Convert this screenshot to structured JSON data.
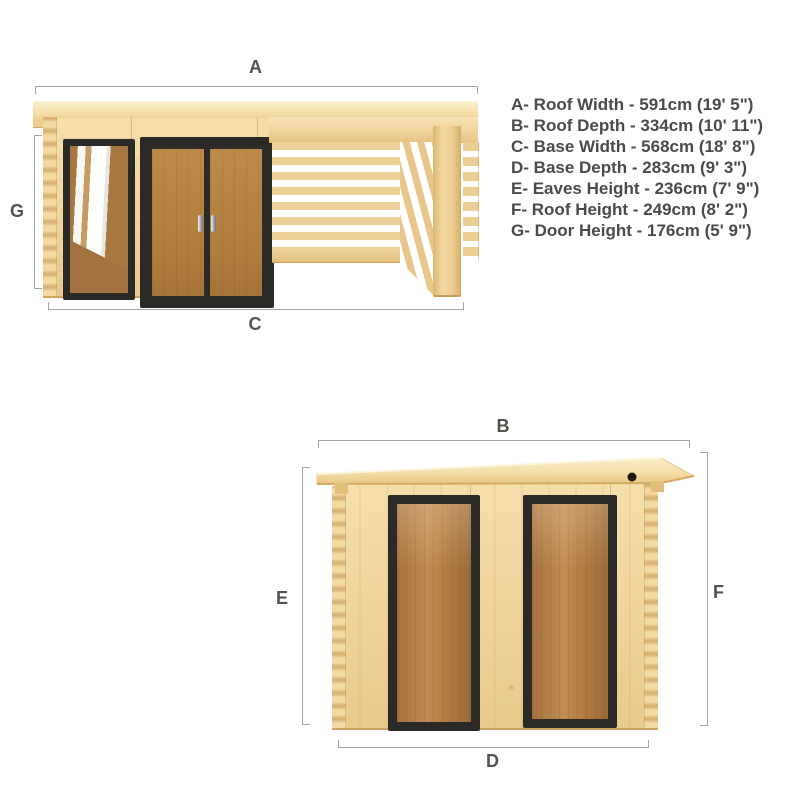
{
  "legend": {
    "items": [
      {
        "text": "A- Roof Width - 591cm (19' 5\")"
      },
      {
        "text": "B- Roof Depth - 334cm (10' 11\")"
      },
      {
        "text": "C- Base Width - 568cm (18' 8\")"
      },
      {
        "text": "D- Base Depth - 283cm (9' 3\")"
      },
      {
        "text": "E- Eaves Height - 236cm (7' 9\")"
      },
      {
        "text": "F- Roof Height - 249cm (8' 2\")"
      },
      {
        "text": "G- Door Height - 176cm (5' 9\")"
      }
    ]
  },
  "front_view": {
    "dim_a": "A",
    "dim_c": "C",
    "dim_g": "G"
  },
  "side_view": {
    "dim_b": "B",
    "dim_d": "D",
    "dim_e": "E",
    "dim_f": "F"
  },
  "colors": {
    "wood_light": "#f3dba4",
    "wood_mid": "#eccd92",
    "wood_dark": "#d8ae69",
    "roof_highlight": "#faeecb",
    "frame_dark": "#2b2a26",
    "door_wood": "#b5803f",
    "glass_interior": "#ad7a44",
    "dimension_line": "#a5a5a3",
    "label_text": "#4b4a47",
    "background": "#ffffff"
  }
}
